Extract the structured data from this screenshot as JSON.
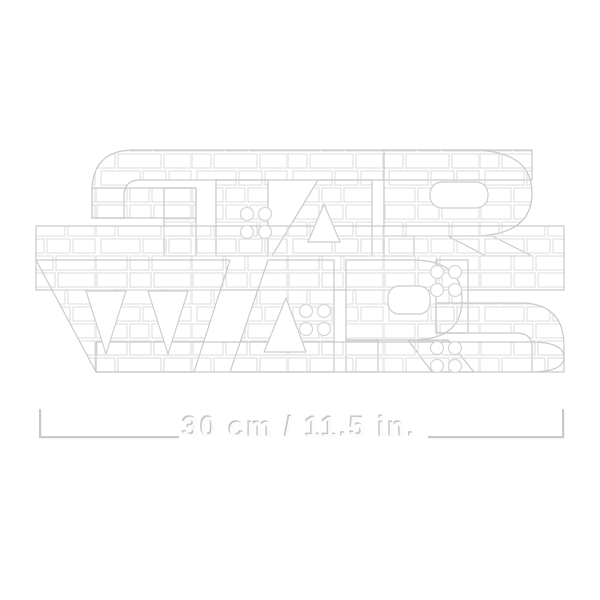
{
  "artwork": {
    "word_top": "STAR",
    "word_bottom": "WARS",
    "style": "brick-built outline line art",
    "brick_line_color": "#dfdfdf",
    "edge_line_color": "#c9c9c9",
    "background_color": "#ffffff"
  },
  "dimension": {
    "label": "30 cm / 11.5 in.",
    "line_color": "#c9c9c9",
    "text_fill_color": "#fcfcfc",
    "text_shadow_color": "#c6c6c6"
  }
}
